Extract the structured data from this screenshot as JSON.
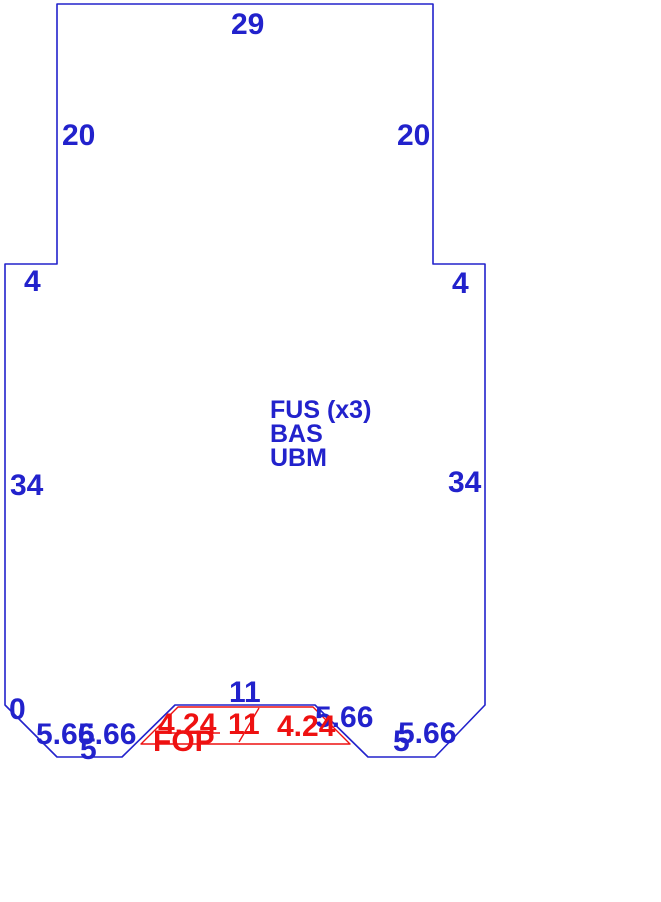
{
  "drawing": {
    "title": "part-outline-with-dimensions",
    "canvas": {
      "width": 661,
      "height": 902,
      "background": "#ffffff"
    },
    "colors": {
      "blue": "#2222cc",
      "red": "#ee1111"
    },
    "shapes": [
      {
        "name": "part-outline",
        "type": "polygon",
        "color": "blue",
        "stroke_width": 1.6,
        "points": "57,4 433,4 433,264 485,264 485,705 435,757 368,757 315,705 175,705 122,757 57,757 5,705 5,264 57,264"
      },
      {
        "name": "fop-region-outline",
        "type": "polygon",
        "color": "red",
        "stroke_width": 1.4,
        "points": "178,707 313,707 350,744 141,744"
      },
      {
        "name": "fop-leader-line",
        "type": "line",
        "color": "red",
        "stroke_width": 1.4,
        "x1": 239,
        "y1": 742,
        "x2": 259,
        "y2": 708
      },
      {
        "name": "fop-underline",
        "type": "line",
        "color": "red",
        "stroke_width": 1.4,
        "x1": 155,
        "y1": 733,
        "x2": 220,
        "y2": 733
      }
    ],
    "labels": [
      {
        "name": "dim-top-29",
        "text": "29",
        "x": 231,
        "y": 12,
        "size": 30,
        "color": "blue"
      },
      {
        "name": "dim-left-20",
        "text": "20",
        "x": 62,
        "y": 123,
        "size": 30,
        "color": "blue"
      },
      {
        "name": "dim-right-20",
        "text": "20",
        "x": 397,
        "y": 123,
        "size": 30,
        "color": "blue"
      },
      {
        "name": "dim-left-step-4",
        "text": "4",
        "x": 24,
        "y": 269,
        "size": 30,
        "color": "blue"
      },
      {
        "name": "dim-right-step-4",
        "text": "4",
        "x": 452,
        "y": 271,
        "size": 30,
        "color": "blue"
      },
      {
        "name": "dim-left-34",
        "text": "34",
        "x": 10,
        "y": 473,
        "size": 30,
        "color": "blue"
      },
      {
        "name": "dim-right-34",
        "text": "34",
        "x": 448,
        "y": 470,
        "size": 30,
        "color": "blue"
      },
      {
        "name": "layer-text-fus",
        "text": "FUS (x3)",
        "x": 270,
        "y": 400,
        "size": 25,
        "color": "blue"
      },
      {
        "name": "layer-text-bas",
        "text": "BAS",
        "x": 270,
        "y": 424,
        "size": 25,
        "color": "blue"
      },
      {
        "name": "layer-text-ubm",
        "text": "UBM",
        "x": 270,
        "y": 448,
        "size": 25,
        "color": "blue"
      },
      {
        "name": "dim-zero",
        "text": "0",
        "x": 9,
        "y": 697,
        "size": 30,
        "color": "blue"
      },
      {
        "name": "dim-chamfer-left-566",
        "text": "5.66",
        "x": 36,
        "y": 722,
        "size": 30,
        "color": "blue"
      },
      {
        "name": "dim-notch-left-566",
        "text": "5.66",
        "x": 78,
        "y": 722,
        "size": 30,
        "color": "blue"
      },
      {
        "name": "dim-bottom-left-5",
        "text": "5",
        "x": 80,
        "y": 737,
        "size": 30,
        "color": "blue"
      },
      {
        "name": "dim-notch-top-11",
        "text": "11",
        "x": 229,
        "y": 680,
        "size": 30,
        "color": "blue"
      },
      {
        "name": "dim-notch-right-566",
        "text": "5.66",
        "x": 315,
        "y": 705,
        "size": 30,
        "color": "blue"
      },
      {
        "name": "dim-bottom-right-5",
        "text": "5",
        "x": 393,
        "y": 729,
        "size": 30,
        "color": "blue"
      },
      {
        "name": "dim-chamfer-right-566",
        "text": "5.66",
        "x": 398,
        "y": 721,
        "size": 30,
        "color": "blue"
      },
      {
        "name": "dim-fop-left-424",
        "text": "4.24",
        "x": 158,
        "y": 712,
        "size": 30,
        "color": "red"
      },
      {
        "name": "dim-fop-top-11",
        "text": "11",
        "x": 228,
        "y": 712,
        "size": 30,
        "color": "red"
      },
      {
        "name": "dim-fop-right-424",
        "text": "4.24",
        "x": 277,
        "y": 714,
        "size": 30,
        "color": "red"
      },
      {
        "name": "layer-text-fop",
        "text": "FOP",
        "x": 153,
        "y": 729,
        "size": 30,
        "color": "red"
      }
    ]
  }
}
